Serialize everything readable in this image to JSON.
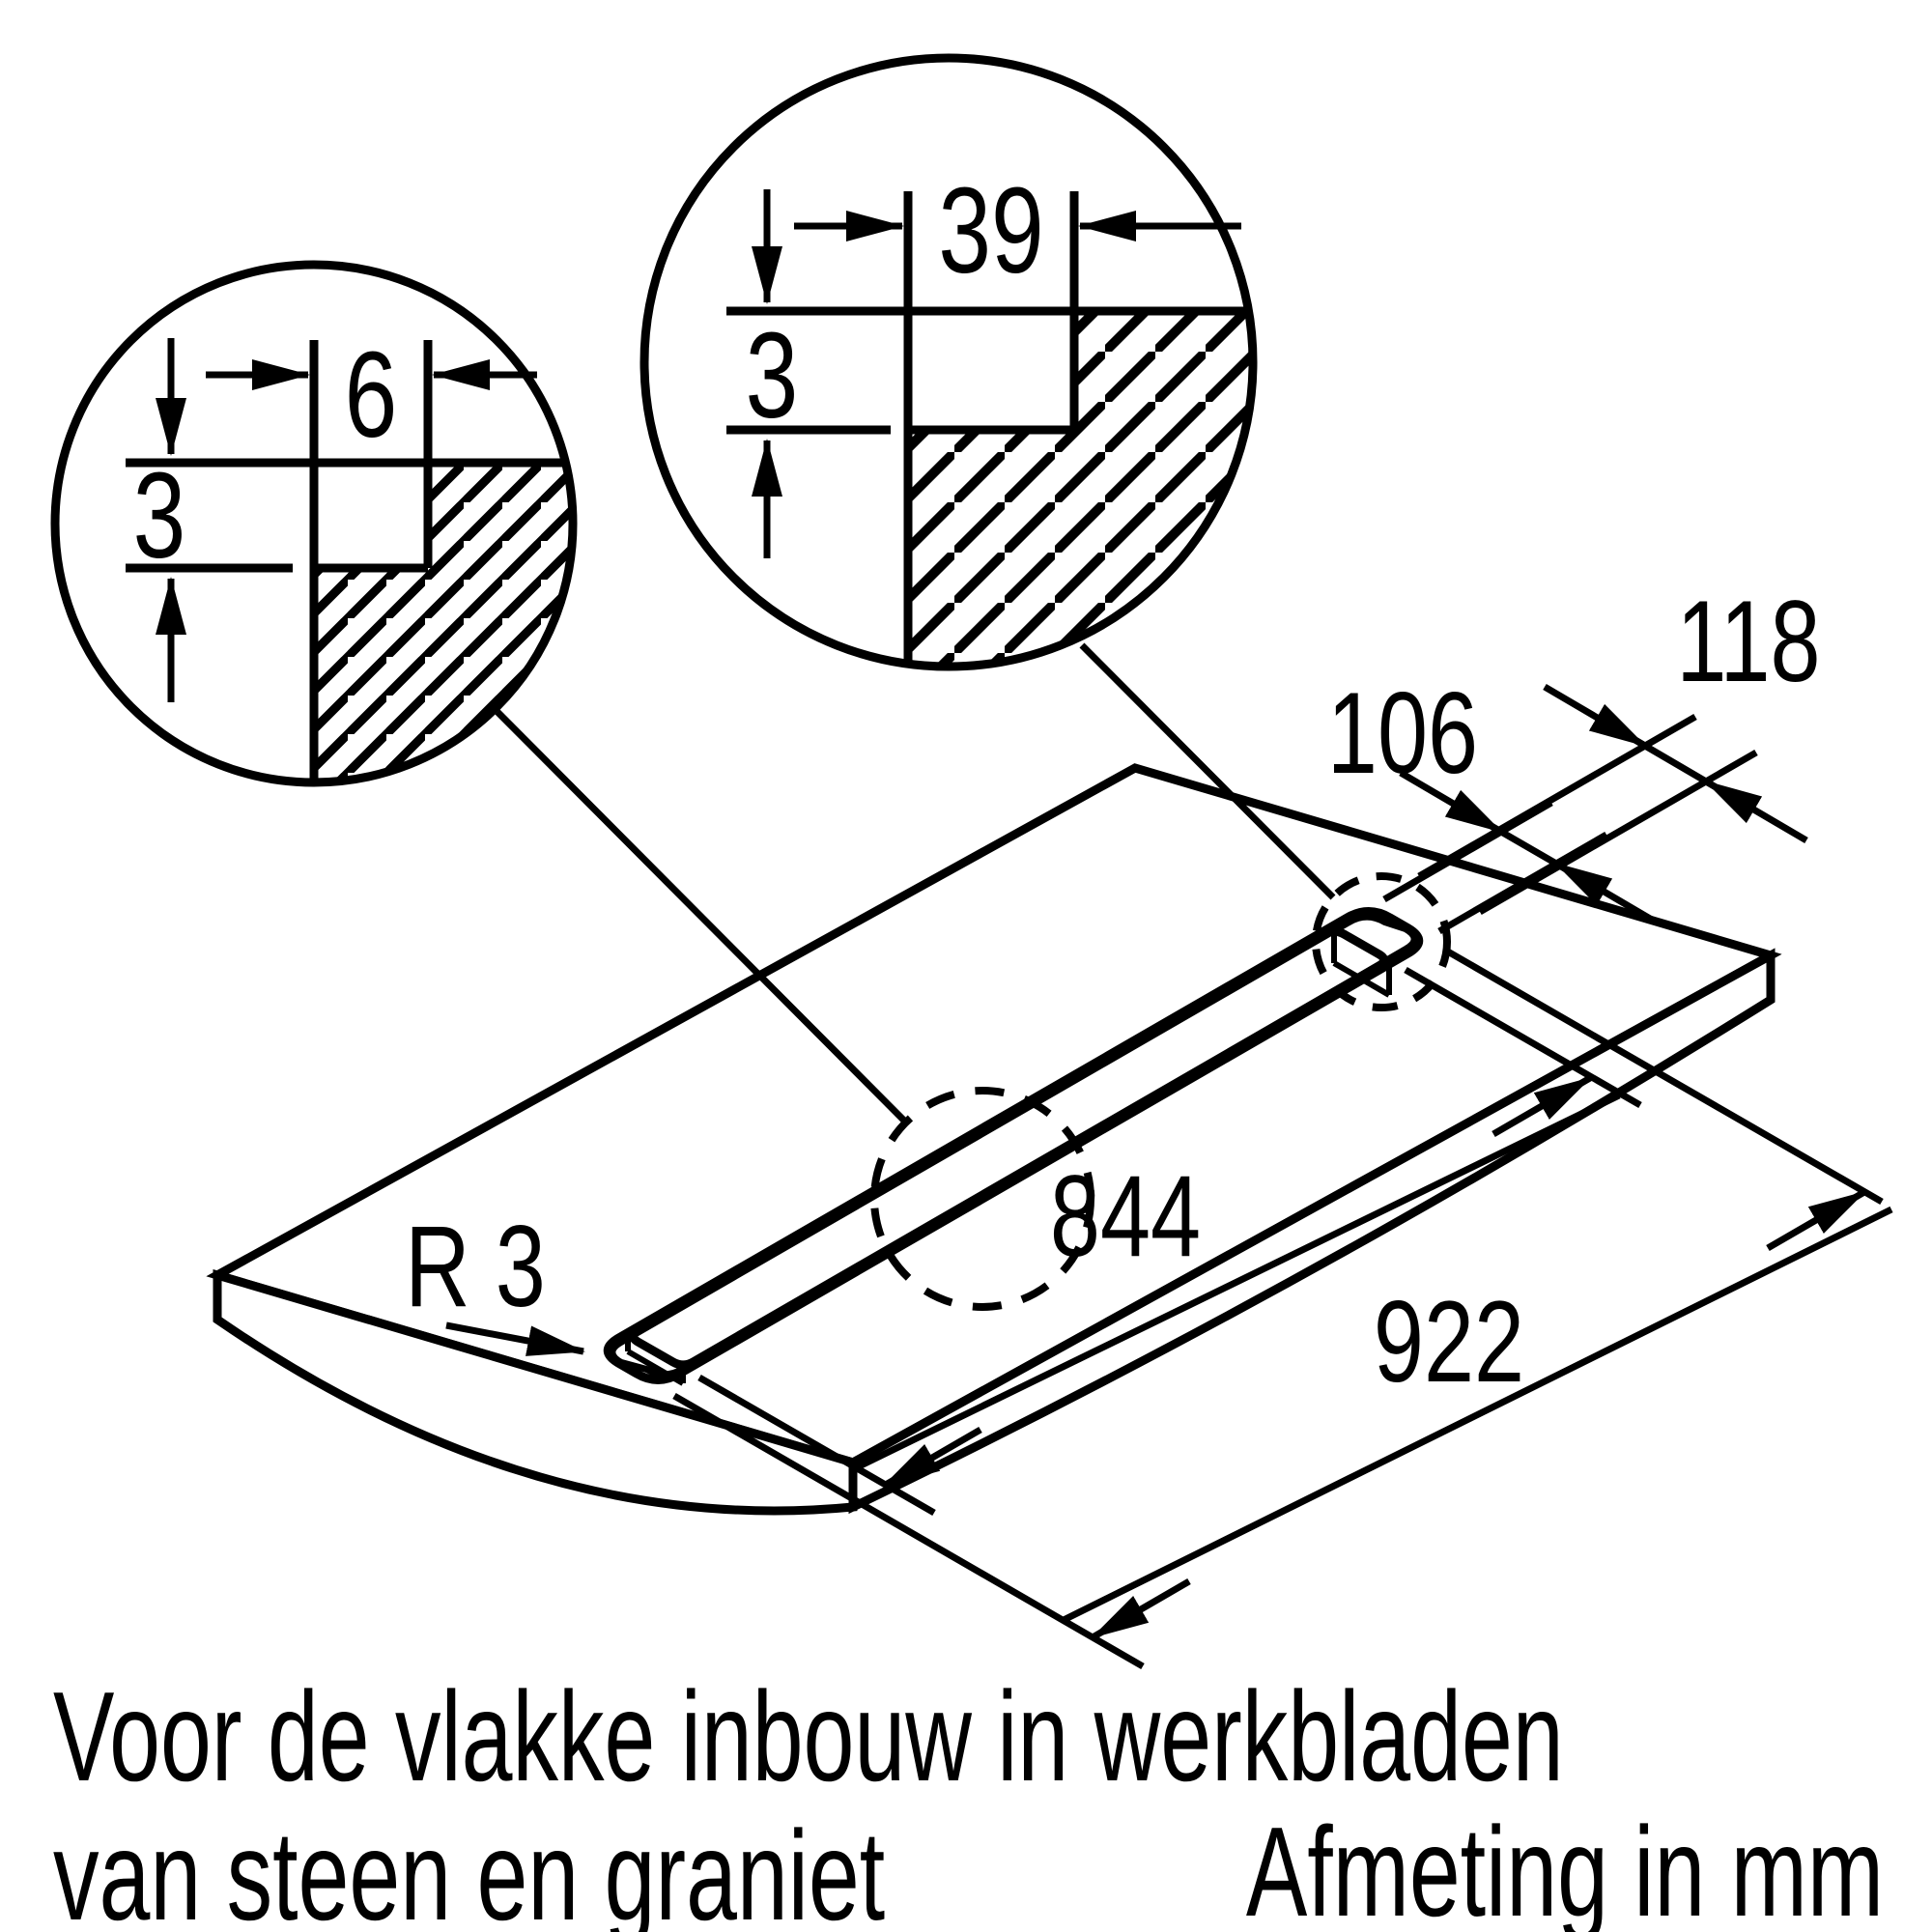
{
  "labels": {
    "detail_small_width": "6",
    "detail_small_depth": "3",
    "detail_large_width": "39",
    "detail_large_depth": "3",
    "cutout_width": "106",
    "recess_width": "118",
    "cutout_length": "844",
    "recess_length": "922",
    "corner_radius": "R 3",
    "caption_line1": "Voor de vlakke inbouw in werkbladen",
    "caption_line2": "van steen en graniet",
    "footer": "Afmeting in mm"
  },
  "colors": {
    "line": "#000000",
    "background": "#ffffff"
  },
  "units": "mm"
}
